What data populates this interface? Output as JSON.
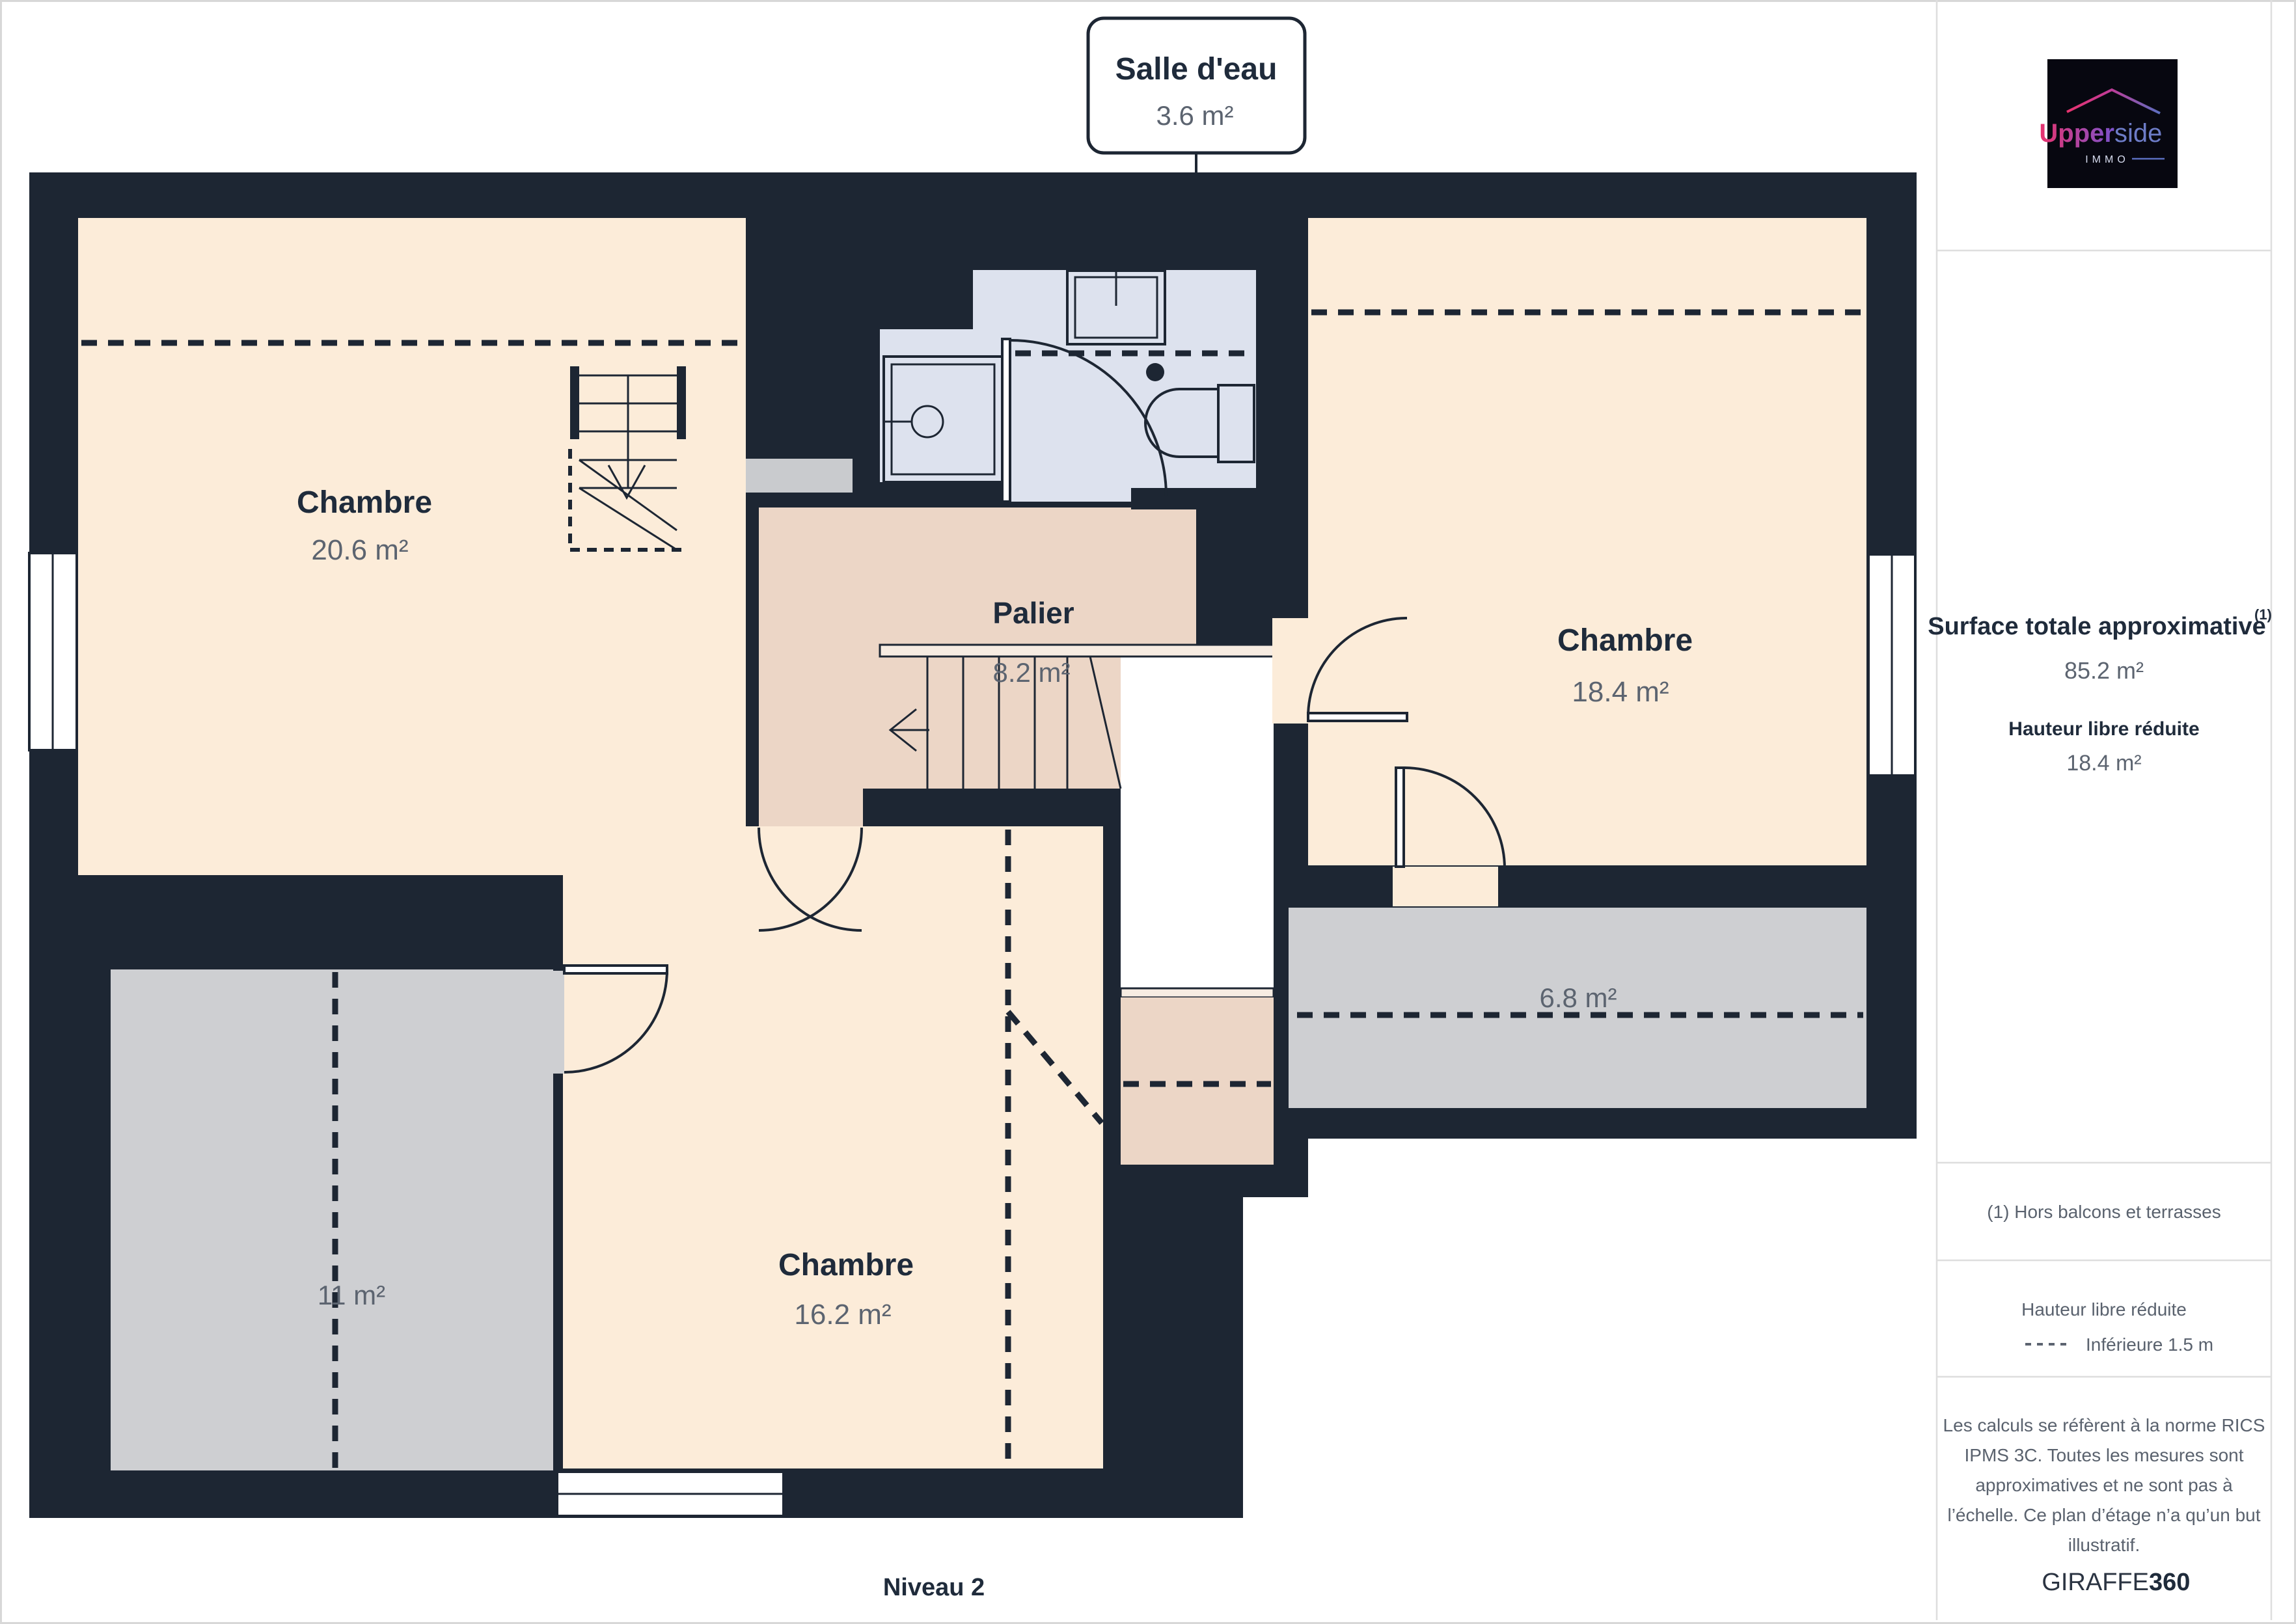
{
  "plan": {
    "level_label": "Niveau 2",
    "callout": {
      "title": "Salle d'eau",
      "area": "3.6 m²"
    },
    "rooms": [
      {
        "id": "chambre-20-6",
        "name": "Chambre",
        "area": "20.6 m²"
      },
      {
        "id": "chambre-18-4",
        "name": "Chambre",
        "area": "18.4 m²"
      },
      {
        "id": "chambre-16-2",
        "name": "Chambre",
        "area": "16.2 m²"
      },
      {
        "id": "palier",
        "name": "Palier",
        "area": "8.2 m²"
      },
      {
        "id": "reduit-11",
        "area": "11 m²"
      },
      {
        "id": "reduit-6-8",
        "area": "6.8 m²"
      }
    ],
    "colors": {
      "wall": "#1d2633",
      "room_cream": "#fcecd9",
      "landing_pink": "#ecd6c6",
      "bathroom_blue": "#dde2ee",
      "reduced_gray": "#cecfd2",
      "label_navy": "#1f2b3b",
      "area_gray": "#5c6470"
    }
  },
  "sidebar": {
    "logo": {
      "brand_bold": "Upper",
      "brand_light": "side",
      "sub": "IMMO",
      "pink": "#e8336e",
      "purple": "#7b52cc",
      "blue": "#5b6fc0"
    },
    "surface_title": "Surface totale approximative",
    "note_marker": "(1)",
    "surface_value": "85.2 m²",
    "reduced_title": "Hauteur libre réduite",
    "reduced_value": "18.4 m²",
    "note": "(1) Hors balcons et terrasses",
    "legend_title": "Hauteur libre réduite",
    "legend_item": "Inférieure 1.5 m",
    "disclaimer_lines": [
      "Les calculs se réfèrent à la norme RICS",
      "IPMS 3C. Toutes les mesures sont",
      "approximatives et ne sont pas à",
      "l’échelle. Ce plan d’étage n’a qu’un but",
      "illustratif."
    ],
    "brand_left": "GIRAFFE",
    "brand_right": "360"
  }
}
